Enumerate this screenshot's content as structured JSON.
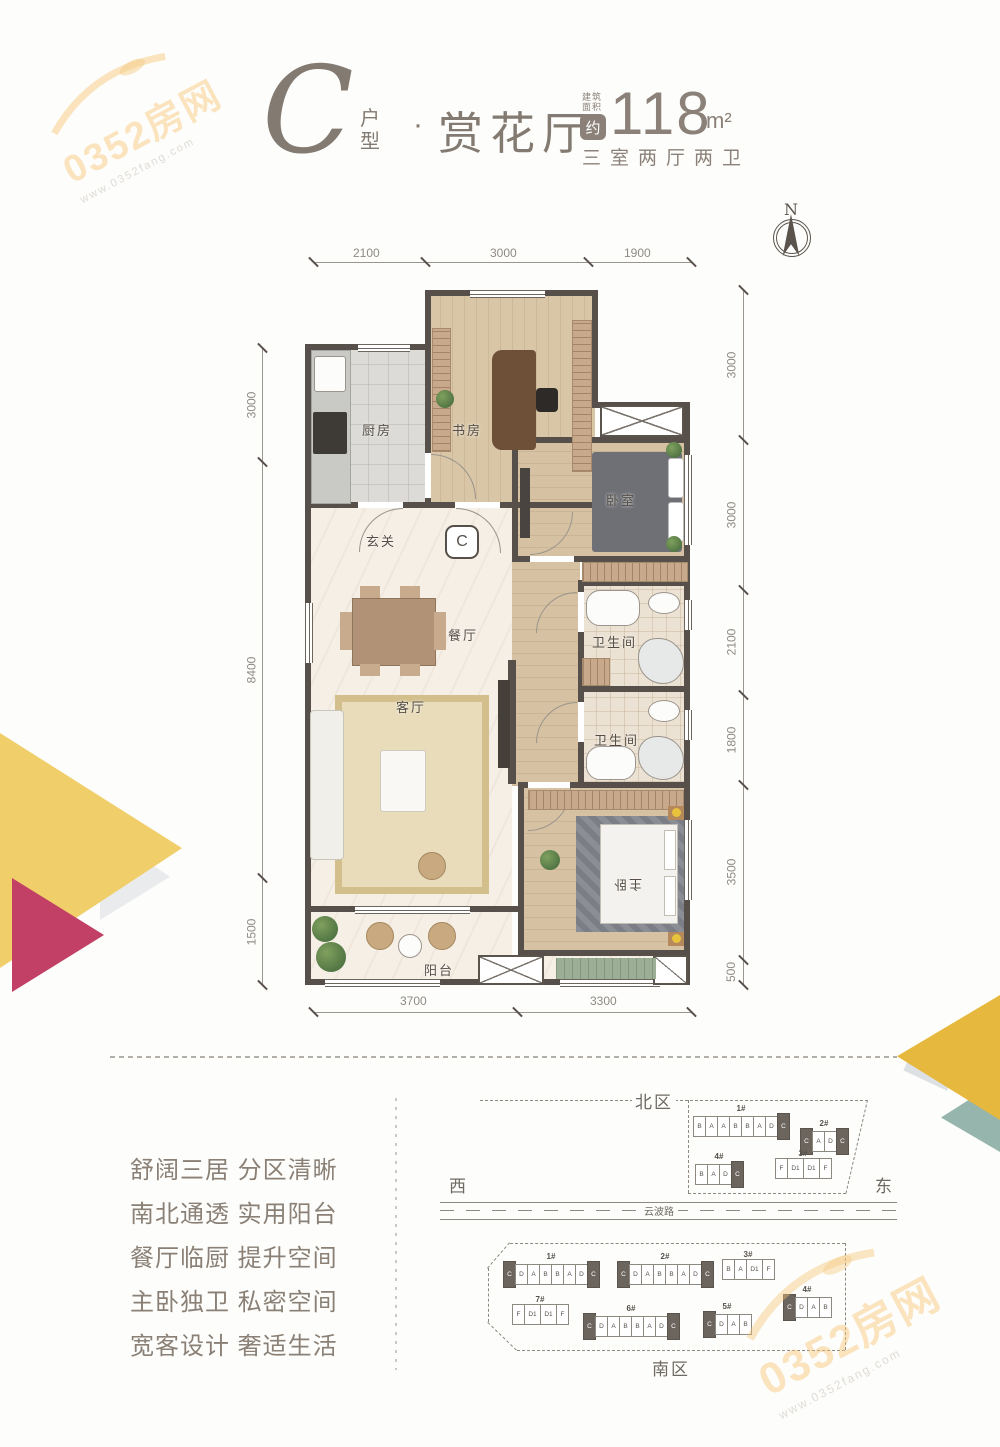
{
  "watermark": {
    "brand": "0352房网",
    "site": "www.0352fang.com"
  },
  "header": {
    "type_letter": "C",
    "type_label": "户型",
    "separator": "·",
    "plan_name": "赏花厅",
    "area_caption1": "建筑",
    "area_caption2": "面积",
    "area_approx": "约",
    "area_value": "118",
    "area_unit": "m²",
    "rooms_summary": "三室两厅两卫"
  },
  "compass": {
    "north": "N"
  },
  "floorplan": {
    "marker": "C",
    "rooms": {
      "kitchen": "厨房",
      "study": "书房",
      "bedroom": "卧室",
      "entry": "玄关",
      "dining": "餐厅",
      "living": "客厅",
      "bath1": "卫生间",
      "bath2": "卫生间",
      "master": "主卧",
      "balcony": "阳台"
    },
    "dims_top": [
      "2100",
      "3000",
      "1900"
    ],
    "dims_right": [
      "3000",
      "3000",
      "2100",
      "1800",
      "3500",
      "500"
    ],
    "dims_left": [
      "3000",
      "8400",
      "1500"
    ],
    "dims_bottom": [
      "3700",
      "3300"
    ]
  },
  "features": [
    "舒阔三居 分区清晰",
    "南北通透 实用阳台",
    "餐厅临厨 提升空间",
    "主卧独卫 私密空间",
    "宽客设计 奢适生活"
  ],
  "siteplan": {
    "north_district": "北区",
    "south_district": "南区",
    "west": "西",
    "east": "东",
    "road": "云波路",
    "buildings": [
      {
        "id": "n1",
        "district": "north",
        "no": "1#",
        "units": [
          {
            "t": "B"
          },
          {
            "t": "A"
          },
          {
            "t": "A"
          },
          {
            "t": "B"
          },
          {
            "t": "B"
          },
          {
            "t": "A"
          },
          {
            "t": "D"
          },
          {
            "t": "C",
            "hl": true
          }
        ]
      },
      {
        "id": "n2",
        "district": "north",
        "no": "2#",
        "units": [
          {
            "t": "C",
            "hl": true
          },
          {
            "t": "A"
          },
          {
            "t": "D"
          },
          {
            "t": "C",
            "hl": true
          }
        ]
      },
      {
        "id": "n3",
        "district": "north",
        "no": "3#",
        "units": [
          {
            "t": "F"
          },
          {
            "t": "D1"
          },
          {
            "t": "D1"
          },
          {
            "t": "F"
          }
        ]
      },
      {
        "id": "n4",
        "district": "north",
        "no": "4#",
        "units": [
          {
            "t": "B"
          },
          {
            "t": "A"
          },
          {
            "t": "D"
          },
          {
            "t": "C",
            "hl": true
          }
        ]
      },
      {
        "id": "s1",
        "district": "south",
        "no": "1#",
        "units": [
          {
            "t": "C",
            "hl": true
          },
          {
            "t": "D"
          },
          {
            "t": "A"
          },
          {
            "t": "B"
          },
          {
            "t": "B"
          },
          {
            "t": "A"
          },
          {
            "t": "D"
          },
          {
            "t": "C",
            "hl": true
          }
        ]
      },
      {
        "id": "s2",
        "district": "south",
        "no": "2#",
        "units": [
          {
            "t": "C",
            "hl": true
          },
          {
            "t": "D"
          },
          {
            "t": "A"
          },
          {
            "t": "B"
          },
          {
            "t": "B"
          },
          {
            "t": "A"
          },
          {
            "t": "D"
          },
          {
            "t": "C",
            "hl": true
          }
        ]
      },
      {
        "id": "s3",
        "district": "south",
        "no": "3#",
        "units": [
          {
            "t": "B"
          },
          {
            "t": "A"
          },
          {
            "t": "D1"
          },
          {
            "t": "F"
          }
        ]
      },
      {
        "id": "s4",
        "district": "south",
        "no": "4#",
        "units": [
          {
            "t": "C",
            "hl": true
          },
          {
            "t": "D"
          },
          {
            "t": "A"
          },
          {
            "t": "B"
          }
        ]
      },
      {
        "id": "s5",
        "district": "south",
        "no": "5#",
        "units": [
          {
            "t": "C",
            "hl": true
          },
          {
            "t": "D"
          },
          {
            "t": "A"
          },
          {
            "t": "B"
          }
        ]
      },
      {
        "id": "s6",
        "district": "south",
        "no": "6#",
        "units": [
          {
            "t": "C",
            "hl": true
          },
          {
            "t": "D"
          },
          {
            "t": "A"
          },
          {
            "t": "B"
          },
          {
            "t": "B"
          },
          {
            "t": "A"
          },
          {
            "t": "D"
          },
          {
            "t": "C",
            "hl": true
          }
        ]
      },
      {
        "id": "s7",
        "district": "south",
        "no": "7#",
        "units": [
          {
            "t": "F"
          },
          {
            "t": "D1"
          },
          {
            "t": "D1"
          },
          {
            "t": "F"
          }
        ]
      }
    ]
  },
  "colors": {
    "wall": "#57504a",
    "title": "#837a71",
    "accent_yellow": "#f0cf6b",
    "accent_magenta": "#c23f66",
    "accent_gold": "#e6b83e",
    "accent_teal": "#96b6ad"
  }
}
